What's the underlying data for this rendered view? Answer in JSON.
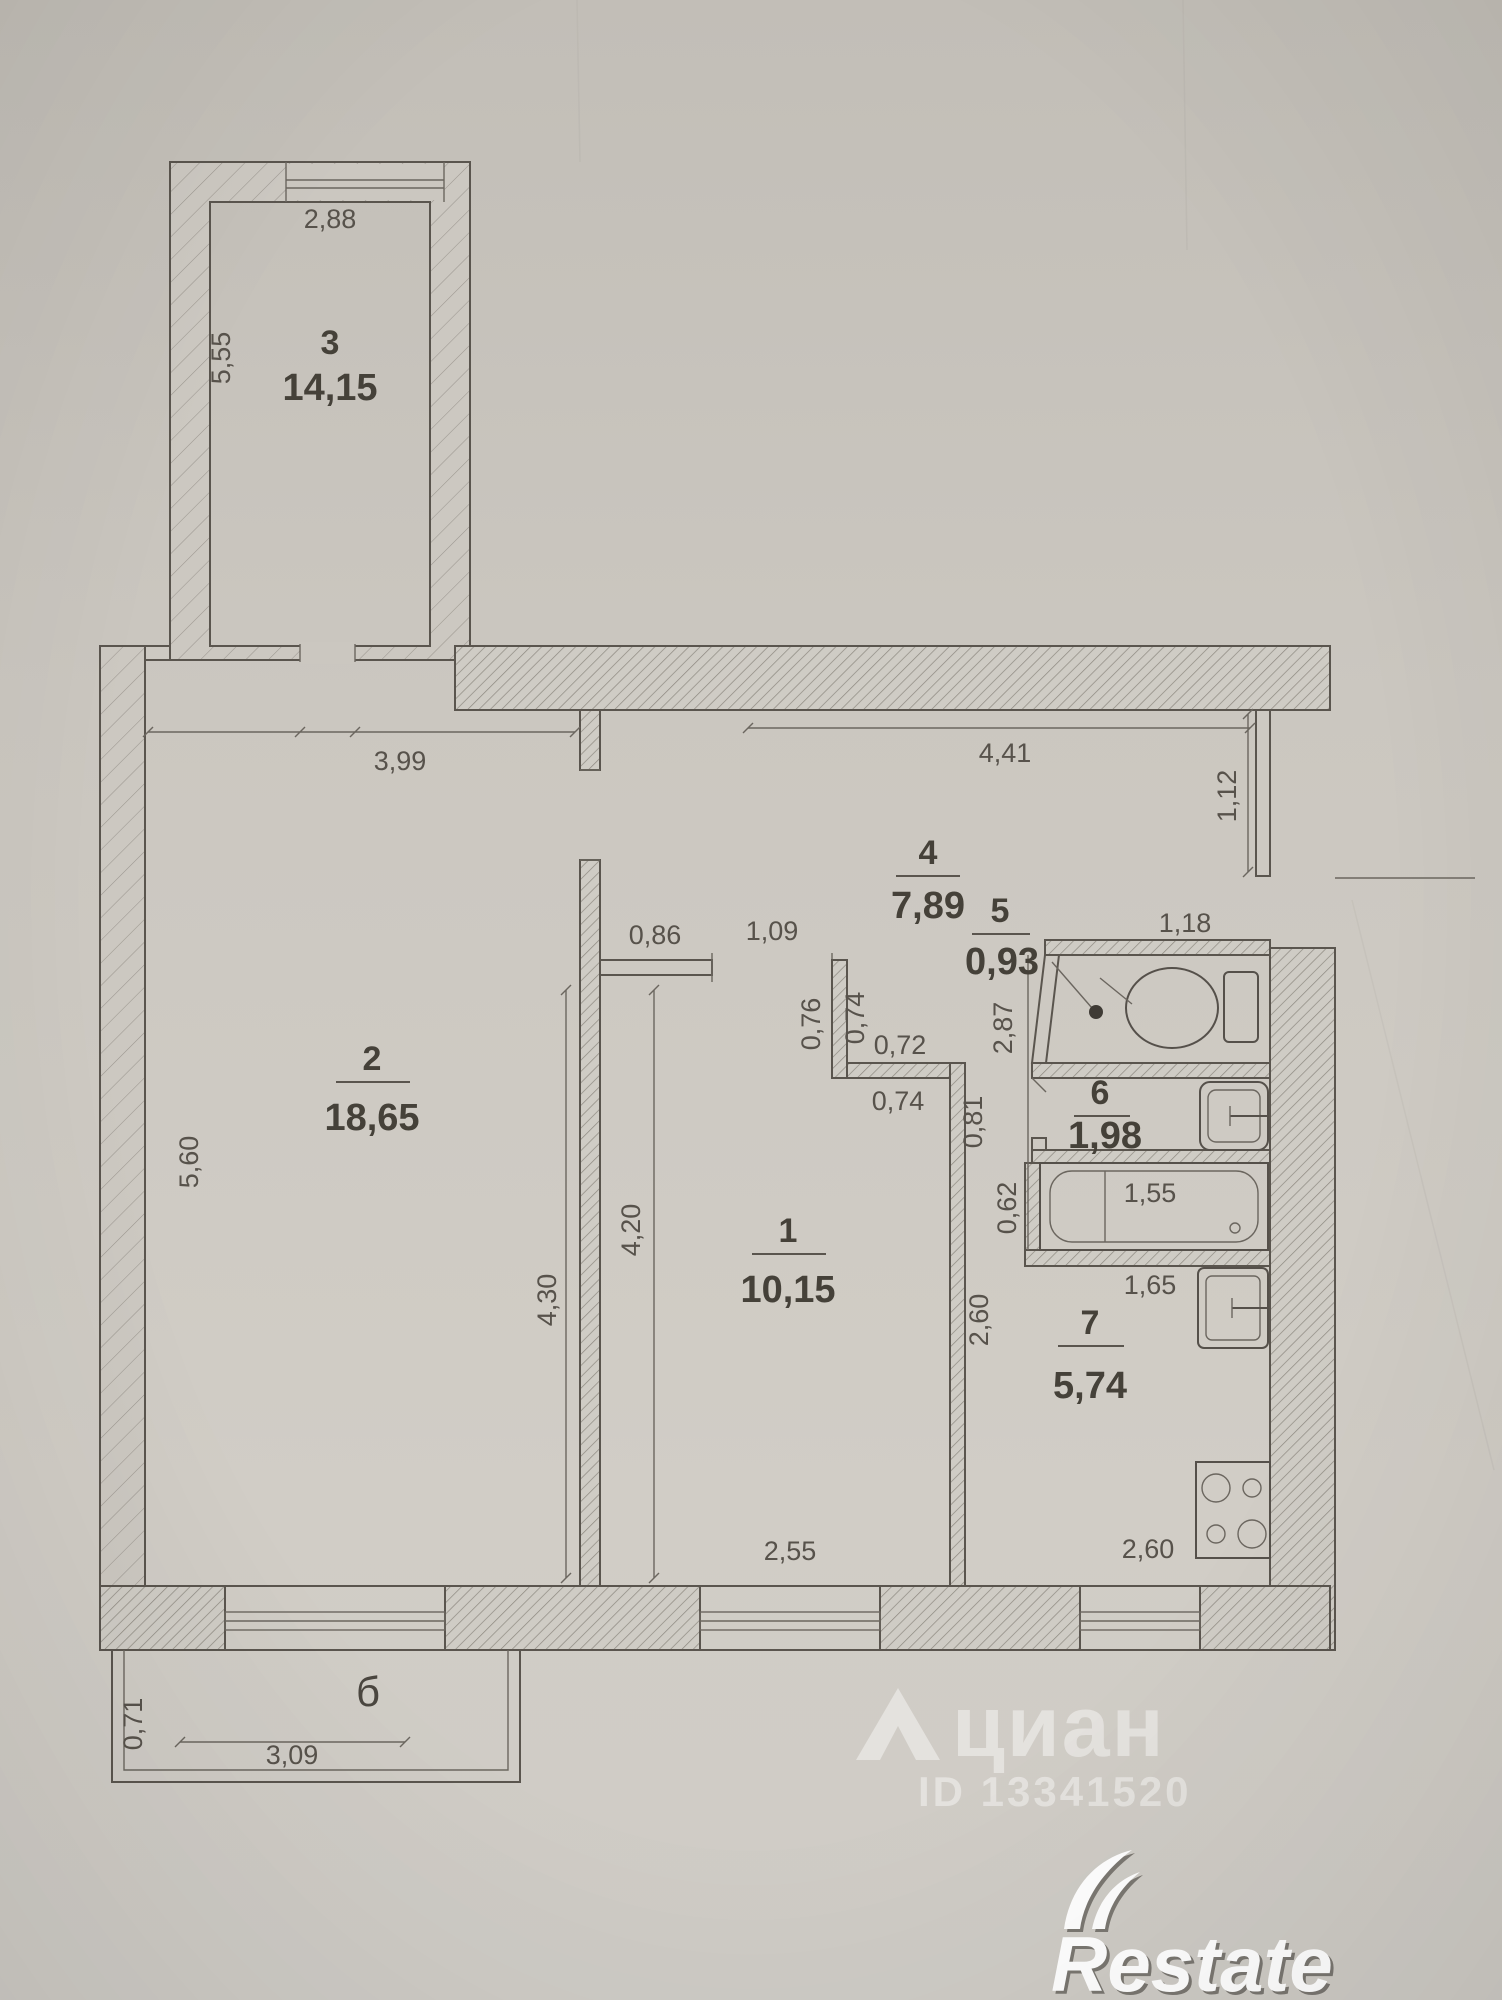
{
  "plan": {
    "rooms": {
      "r1": {
        "number": "1",
        "area": "10,15"
      },
      "r2": {
        "number": "2",
        "area": "18,65"
      },
      "r3": {
        "number": "3",
        "area": "14,15"
      },
      "r4": {
        "number": "4",
        "area": "7,89"
      },
      "r5": {
        "number": "5",
        "area": "0,93"
      },
      "r6": {
        "number": "6",
        "area": "1,98"
      },
      "r7": {
        "number": "7",
        "area": "5,74"
      },
      "balcony": {
        "label": "б"
      }
    },
    "dims": {
      "room3_width": "2,88",
      "room3_height": "5,55",
      "room2_width": "3,99",
      "room2_height_left": "5,60",
      "room2_height_right": "4,30",
      "hall_height": "4,20",
      "hall_width": "2,55",
      "hall_wall": "0,86",
      "hall_door": "1,09",
      "corridor_width": "4,41",
      "entry_wall": "1,12",
      "step_left": "0,76",
      "step_right": "0,74",
      "step_top": "0,72",
      "step_bottom": "0,74",
      "step_side": "0,81",
      "san_wall": "2,87",
      "toilet_width": "1,18",
      "bath_length": "1,55",
      "bath_side": "0,62",
      "bath_width": "1,65",
      "kitchen_height": "2,60",
      "kitchen_width": "2,60",
      "balcony_depth": "0,71",
      "balcony_width": "3,09"
    },
    "watermark": {
      "brand": "циан",
      "listing_id": "ID 13341520"
    },
    "logo": {
      "brand": "Restate"
    }
  }
}
